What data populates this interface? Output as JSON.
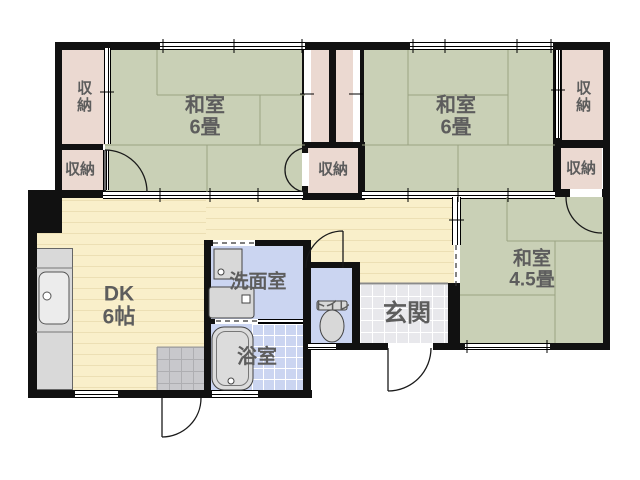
{
  "rooms": {
    "washitsu_left": {
      "name": "和室",
      "size": "6畳"
    },
    "washitsu_right": {
      "name": "和室",
      "size": "6畳"
    },
    "washitsu_small": {
      "name": "和室",
      "size": "4.5畳"
    },
    "dining_kitchen": {
      "name": "DK",
      "size": "6帖"
    },
    "washroom": {
      "name": "洗面室"
    },
    "bathroom": {
      "name": "浴室"
    },
    "toilet": {
      "name": "トイレ"
    },
    "entrance": {
      "name": "玄関"
    }
  },
  "storages": {
    "top_left": {
      "label": "収納"
    },
    "bottom_left": {
      "label": "収納"
    },
    "center": {
      "label": "収納"
    },
    "top_right": {
      "label": "収納"
    },
    "bottom_right": {
      "label": "収納"
    }
  },
  "colors": {
    "wall": "#111111",
    "tatami": "#c9d0b6",
    "tatami_line": "#9aa383",
    "closet": "#ebd9d1",
    "floor": "#f9efca",
    "floor_stripe": "#ecdfb4",
    "wet": "#cbd5f1",
    "genkan": "#e8e8ec",
    "doma": "#c8c8cc",
    "fixture": "#d8d8d8",
    "label": "#5d5d5d"
  }
}
